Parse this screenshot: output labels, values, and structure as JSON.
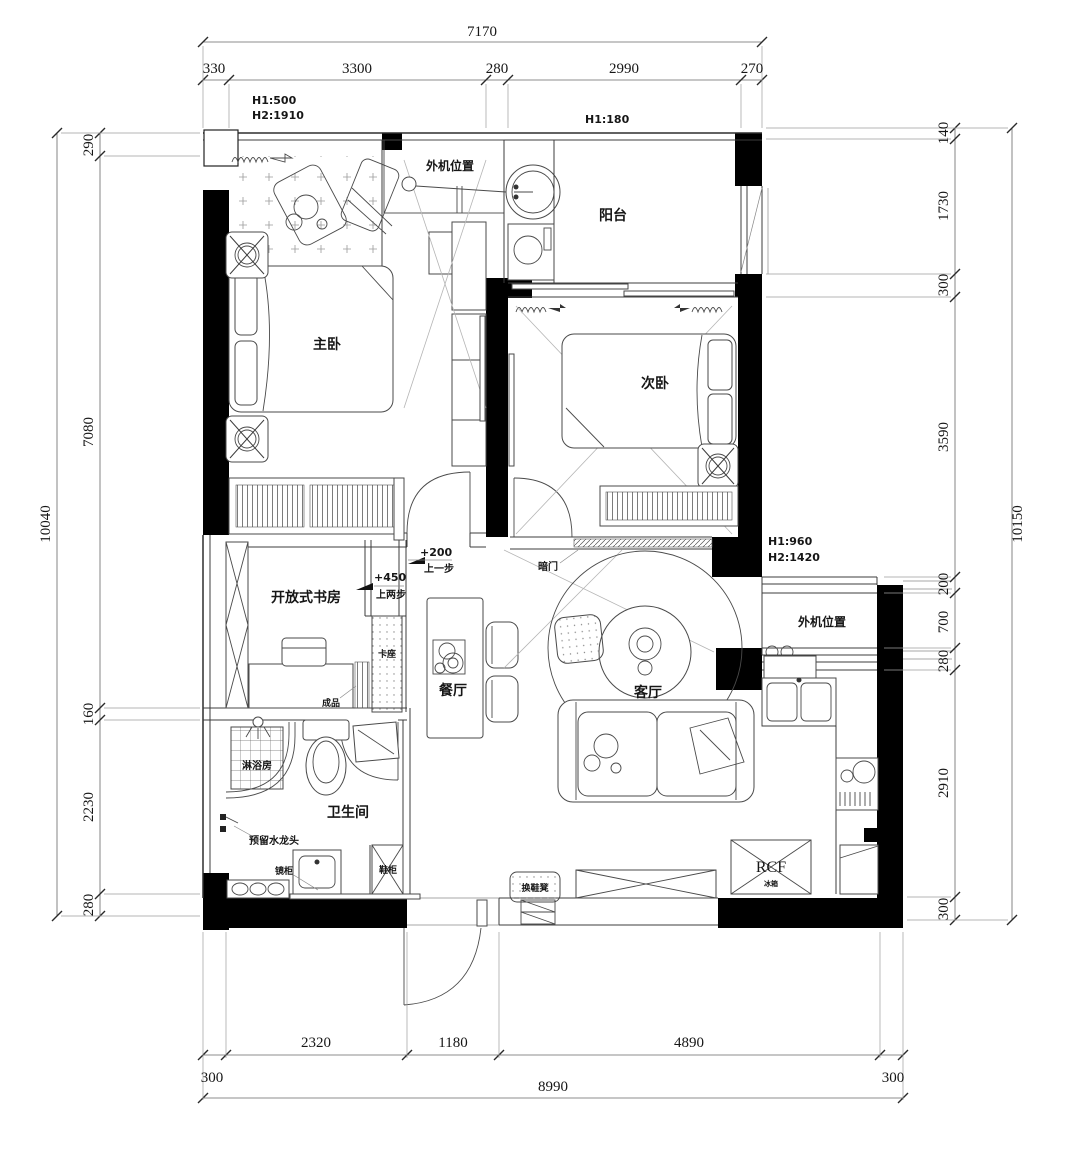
{
  "plan": {
    "dimensions": {
      "top": {
        "total": "7170",
        "segments": [
          "330",
          "3300",
          "280",
          "2990",
          "270"
        ]
      },
      "left": {
        "total": "10040",
        "segments": [
          "290",
          "7080",
          "160",
          "2230",
          "280"
        ]
      },
      "right": {
        "total": "10150",
        "segments": [
          "140",
          "1730",
          "300",
          "3590",
          "200",
          "700",
          "280",
          "2910",
          "300"
        ]
      },
      "bottom": {
        "total": "8990",
        "segments": [
          "2320",
          "1180",
          "4890"
        ],
        "left_offset": "300",
        "right_offset": "300"
      }
    },
    "heights": {
      "top_left_h1": "H1:500",
      "top_left_h2": "H2:1910",
      "balcony_h1": "H1:180",
      "right_h1": "H1:960",
      "right_h2": "H2:1420"
    },
    "rooms": {
      "master_bedroom": "主卧",
      "second_bedroom": "次卧",
      "balcony": "阳台",
      "living_room": "客厅",
      "dining_room": "餐厅",
      "bathroom": "卫生间",
      "open_study": "开放式书房",
      "shower_room": "淋浴房"
    },
    "features": {
      "ac_outdoor_top": "外机位置",
      "ac_outdoor_right": "外机位置",
      "hidden_door": "暗门",
      "booth_seat": "卡座",
      "finished_item": "成品",
      "mirror_cabinet": "镜柜",
      "shoe_cabinet": "鞋柜",
      "shoe_bench": "换鞋凳",
      "reserved_faucet": "预留水龙头",
      "fridge_code": "RCF",
      "fridge_label": "冰箱"
    },
    "levels": {
      "step1_elevation": "+200",
      "step1_note": "上一步",
      "step2_elevation": "+450",
      "step2_note": "上两步"
    },
    "colors": {
      "wall": "#000000",
      "line": "#3c3c3c",
      "background": "#ffffff"
    }
  }
}
